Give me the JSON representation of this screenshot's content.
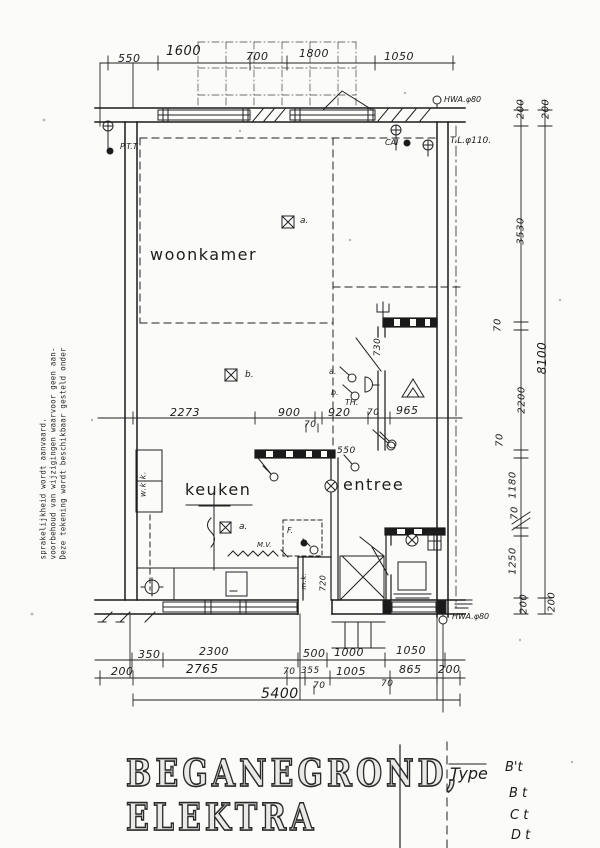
{
  "disclaimer": {
    "lines": [
      "Deze tekening wordt beschikbaar gesteld onder",
      "voorbehoud van wijzigingen waarvoor geen aan-",
      "sprakelijkheid wordt aanvaard."
    ]
  },
  "rooms": {
    "living": "woonkamer",
    "kitchen": "keuken",
    "entrance": "entree"
  },
  "annotations": {
    "ptt": "P.T.T.",
    "cai": "CAI",
    "tl_pipe": "T.L.φ110.",
    "hwa_top": "HWA.φ80",
    "hwa_bottom": "HWA.φ80",
    "wkk": "w.k.k.",
    "mk": "m.k.",
    "mv": "M.V.",
    "thermostat": "TH.",
    "fridge": "F.",
    "light_a": "a.",
    "light_b": "b.",
    "switch_a": "a.",
    "switch_b": "b.",
    "kitchen_light_a": "a."
  },
  "dims": {
    "top": [
      "550",
      "1600",
      "700",
      "1800",
      "1050"
    ],
    "right_inner": [
      "200",
      "3530",
      "70",
      "2200",
      "70",
      "1180",
      "70",
      "1250",
      "200"
    ],
    "right_outer": [
      "200",
      "8100",
      "200"
    ],
    "middle": [
      "2273",
      "900",
      "920",
      "70",
      "965"
    ],
    "middle_below": "70",
    "hall_width": "730",
    "hall_opening": "550",
    "meter_cupboard": "720",
    "bottom_row1": [
      "350",
      "2300",
      "500",
      "1000",
      "1050"
    ],
    "bottom_row2": [
      "200",
      "2765",
      "70",
      "355",
      "1005",
      "865",
      "200"
    ],
    "bottom_row2_below": [
      "70",
      "70"
    ],
    "bottom_total": "5400"
  },
  "title": {
    "line1": "BEGANEGROND,",
    "line2": "ELEKTRA"
  },
  "type_table": {
    "heading": "Type",
    "rows": [
      "B't",
      "B t",
      "C t",
      "D t"
    ]
  }
}
